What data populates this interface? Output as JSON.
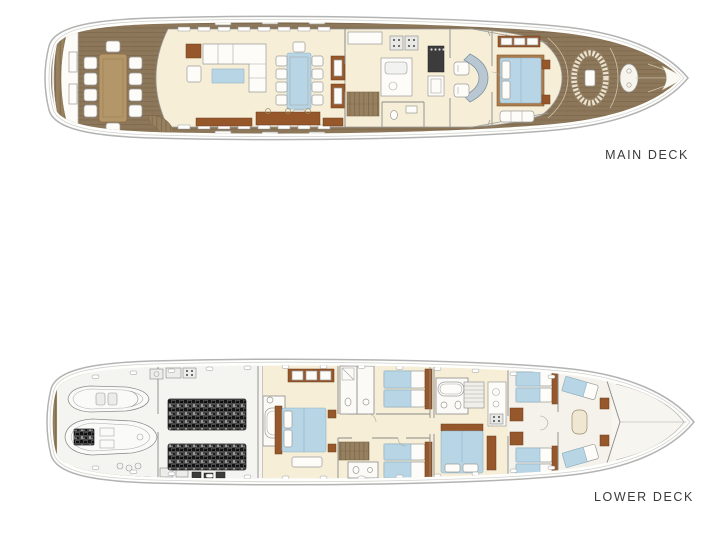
{
  "page": {
    "background": "#ffffff",
    "content": "yacht-deck-plan-drawing"
  },
  "decks": [
    {
      "id": "main-deck",
      "label": "MAIN DECK",
      "areas": [
        "swim-platform",
        "aft-deck-dining",
        "salon-lounge",
        "dining-area",
        "galley",
        "day-head",
        "staircase",
        "wheelhouse",
        "master-cabin",
        "foredeck-seating",
        "bow-sunpad"
      ]
    },
    {
      "id": "lower-deck",
      "label": "LOWER DECK",
      "areas": [
        "swim-platform",
        "tender-garage",
        "engine-room",
        "vip-cabin",
        "guest-twin-cabin-port",
        "guest-twin-cabin-starboard",
        "staircase",
        "forward-double-cabin",
        "crew-galley",
        "crew-cabins",
        "bow-crew-cabin"
      ]
    }
  ],
  "colors": {
    "deck_wood": "#8d775a",
    "plank_line": "#776347",
    "interior_floor": "#f6eed7",
    "furniture_white": "#fdfcf8",
    "upholstery_blue": "#b7d5e5",
    "cabinet_brown": "#96572b",
    "bed_frame_wood": "#aa7b4c",
    "table_wood": "#b3976a",
    "hull_line": "#b3b3b3",
    "wall_line": "#8a8a8a",
    "engine_dark": "#3c3c3c",
    "label_text": "#3b3b3b"
  }
}
